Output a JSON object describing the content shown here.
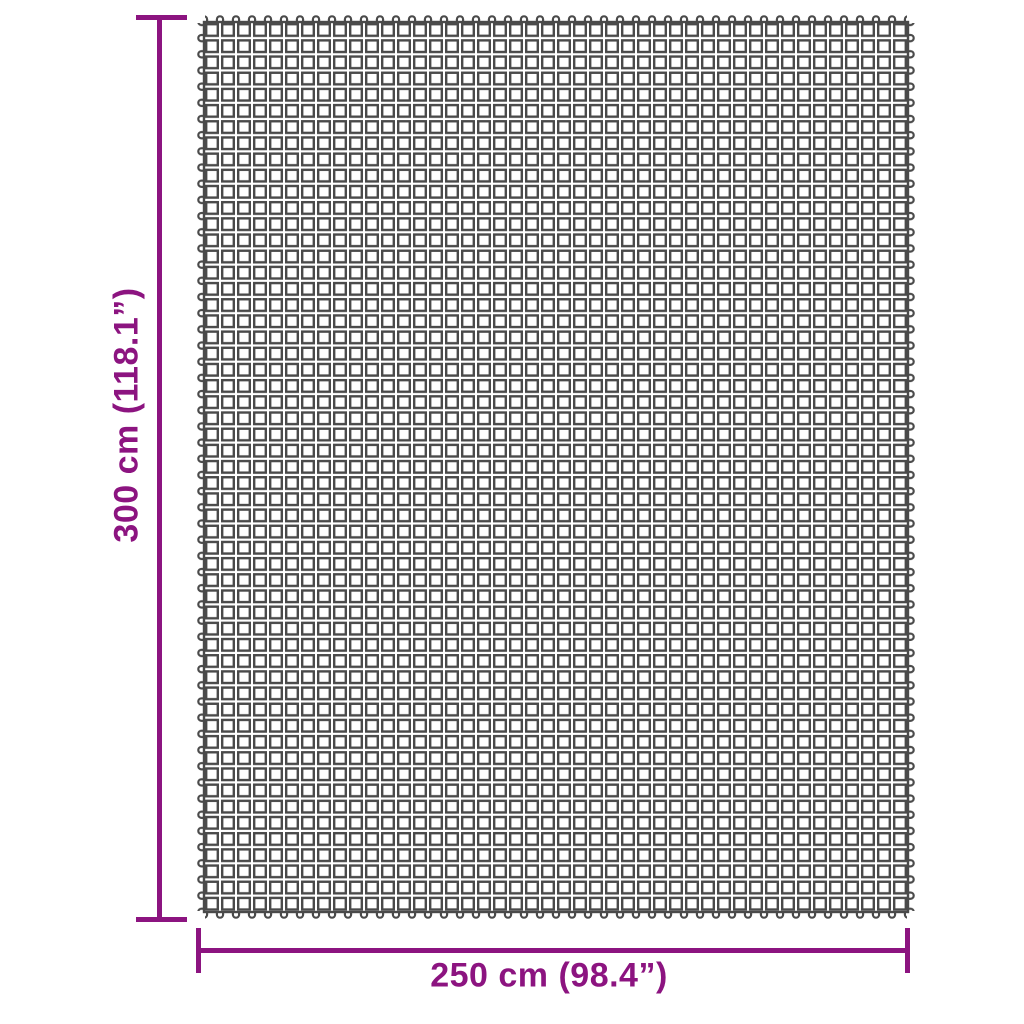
{
  "diagram": {
    "kind": "product-dimension-diagram",
    "vertical_dimension_label": "300 cm (118.1”)",
    "horizontal_dimension_label": "250 cm (98.4”)",
    "colors": {
      "dimension_accent": "#8C1480",
      "grid_line": "#4A4A4A",
      "background": "#FFFFFF"
    },
    "mat": {
      "description": "rectangular mesh mat of square cells with loop tabs on all four edges",
      "columns": 44,
      "rows": 55
    }
  }
}
